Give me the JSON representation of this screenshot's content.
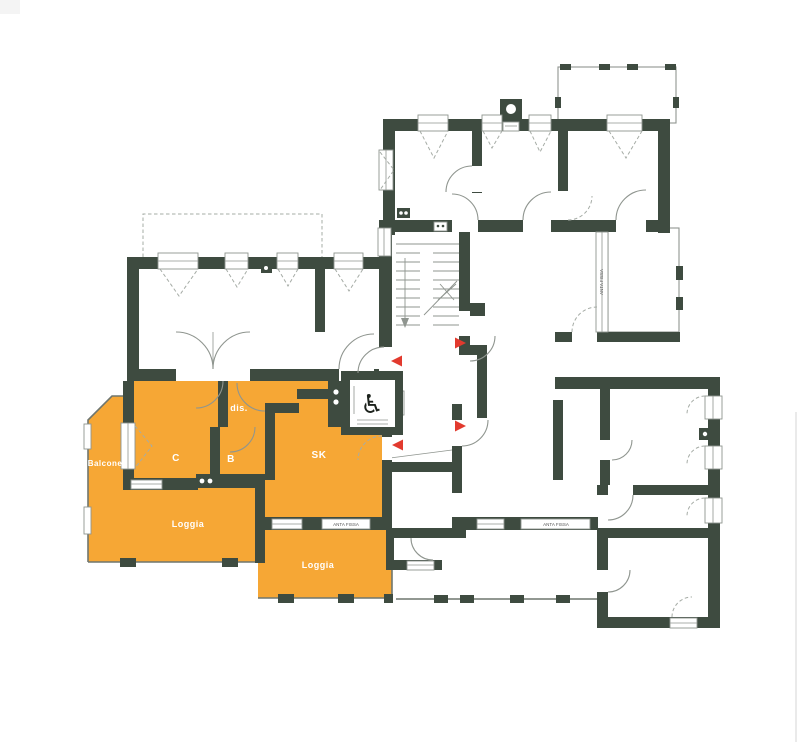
{
  "meta": {
    "drawing_type": "apartment-floor-plan",
    "highlighted_unit_rooms": 7
  },
  "colors": {
    "background": "#ffffff",
    "wall": "#3e4b40",
    "highlight": "#f6a735",
    "line": "#8f958f",
    "dashline": "#a6aca6",
    "railing": "#6f766f",
    "arrow": "#e23a2e",
    "label_text": "#ffffff",
    "annotation_text": "#555555"
  },
  "plan": {
    "labels": [
      {
        "text": "Balcone",
        "x": 105,
        "y": 466,
        "size": 8
      },
      {
        "text": "C",
        "x": 176,
        "y": 461,
        "size": 10
      },
      {
        "text": "B",
        "x": 231,
        "y": 462,
        "size": 10
      },
      {
        "text": "dis.",
        "x": 239,
        "y": 411,
        "size": 9
      },
      {
        "text": "SK",
        "x": 319,
        "y": 458,
        "size": 10
      },
      {
        "text": "Loggia",
        "x": 188,
        "y": 527,
        "size": 9
      },
      {
        "text": "Loggia",
        "x": 318,
        "y": 568,
        "size": 9
      }
    ],
    "annotations": [
      {
        "text": "ANTA FISSA",
        "x": 346,
        "y": 526,
        "size": 4.5,
        "rot": 0
      },
      {
        "text": "ANTA FISSA",
        "x": 556,
        "y": 526,
        "size": 4.5,
        "rot": 0
      },
      {
        "text": "ANTA FISSA",
        "x": 603,
        "y": 282,
        "size": 4.5,
        "rot": -90
      }
    ],
    "arrows": [
      {
        "tip_x": 391,
        "tip_y": 361,
        "dir": "left"
      },
      {
        "tip_x": 466,
        "tip_y": 343,
        "dir": "right"
      },
      {
        "tip_x": 466,
        "tip_y": 426,
        "dir": "right"
      },
      {
        "tip_x": 392,
        "tip_y": 445,
        "dir": "left"
      }
    ],
    "icons": [
      {
        "name": "wheelchair-icon",
        "glyph": "♿",
        "x": 372,
        "y": 413,
        "size": 26
      }
    ]
  }
}
